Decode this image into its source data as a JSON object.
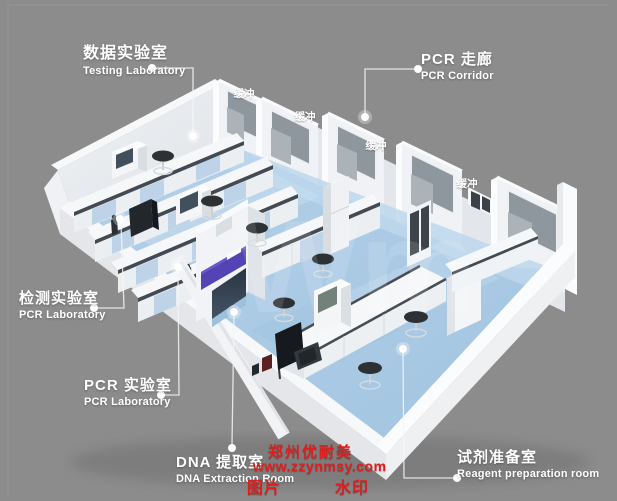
{
  "canvas": {
    "width": 617,
    "height": 501,
    "description": "3D isometric rendering of a PCR laboratory suite floor plan with callout labels"
  },
  "callouts": {
    "testing_lab": {
      "zh": "数据实验室",
      "en": "Testing Laboratory"
    },
    "pcr_corridor": {
      "zh": "PCR 走廊",
      "en": "PCR Corridor"
    },
    "detection_lab": {
      "zh": "检测实验室",
      "en": "PCR Laboratory"
    },
    "pcr_lab": {
      "zh": "PCR 实验室",
      "en": "PCR Laboratory"
    },
    "dna_extraction_room": {
      "zh": "DNA 提取室",
      "en": "DNA Extraction Room"
    },
    "reagent_prep_room": {
      "zh": "试剂准备室",
      "en": "Reagent preparation room"
    }
  },
  "scene_tags": {
    "buffer_room": "缓冲",
    "buffer_room_count": 4,
    "floor_watermark": "Wm"
  },
  "watermark": {
    "brand": "郑州优耐美",
    "url": "www.zzynmsy.com",
    "tag_left": "图片",
    "tag_right": "水印",
    "color": "#da1f1f"
  },
  "colors": {
    "background": "#8c8c8c",
    "floor_blue": "#a9c9e3",
    "corridor_blue": "#bdd7ec",
    "wall_white": "#f0f2f5",
    "wall_shade": "#dde1e5",
    "glass_gray": "#8f979e",
    "bench_top": "#f5f7f9",
    "bench_strip": "#434a51",
    "bench_panel_blue": "#bed3e7",
    "accent_purple": "#5443b4",
    "stool_dark": "#2d3134",
    "equipment_dark": "#22272c",
    "label_white": "#ffffff",
    "watermark_red": "#da1f1f"
  }
}
